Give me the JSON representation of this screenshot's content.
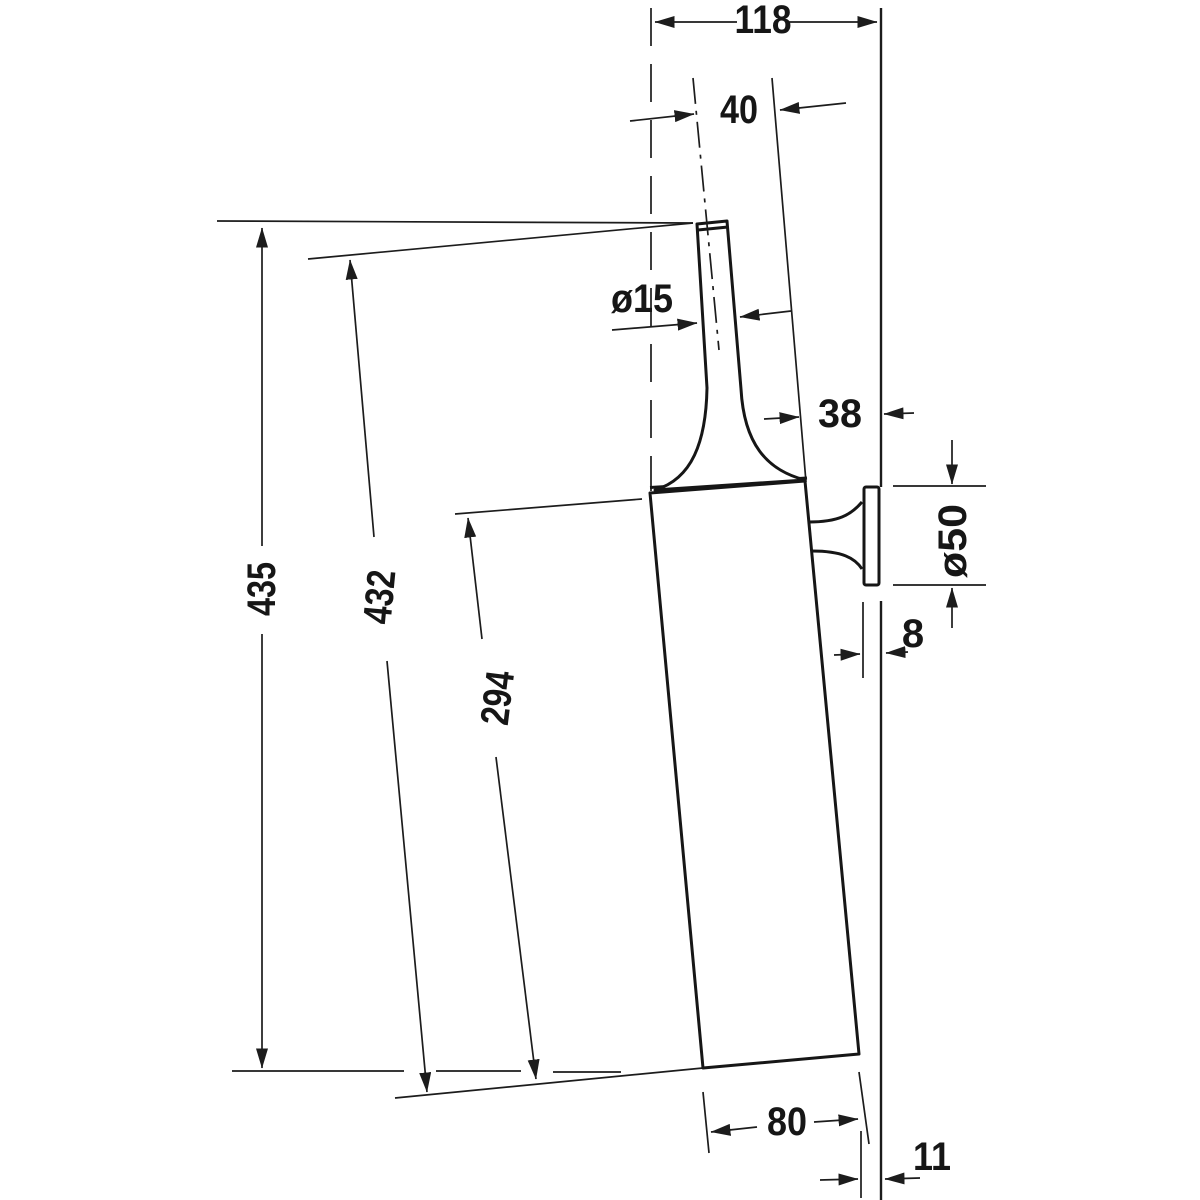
{
  "drawing": {
    "type": "technical-dimension-drawing",
    "subject": "wall-mounted toilet brush set, side elevation",
    "units": "mm",
    "background": "#ffffff",
    "line_color": "#1c1c1c",
    "labels": {
      "total_depth": "118",
      "handle_axis_to_front": "40",
      "handle_diameter": "ø15",
      "body_to_wall": "38",
      "rosette_diameter": "ø50",
      "rosette_depth": "8",
      "total_height": "435",
      "brush_length": "432",
      "container_length": "294",
      "container_width": "80",
      "bottom_to_wall": "11"
    }
  }
}
